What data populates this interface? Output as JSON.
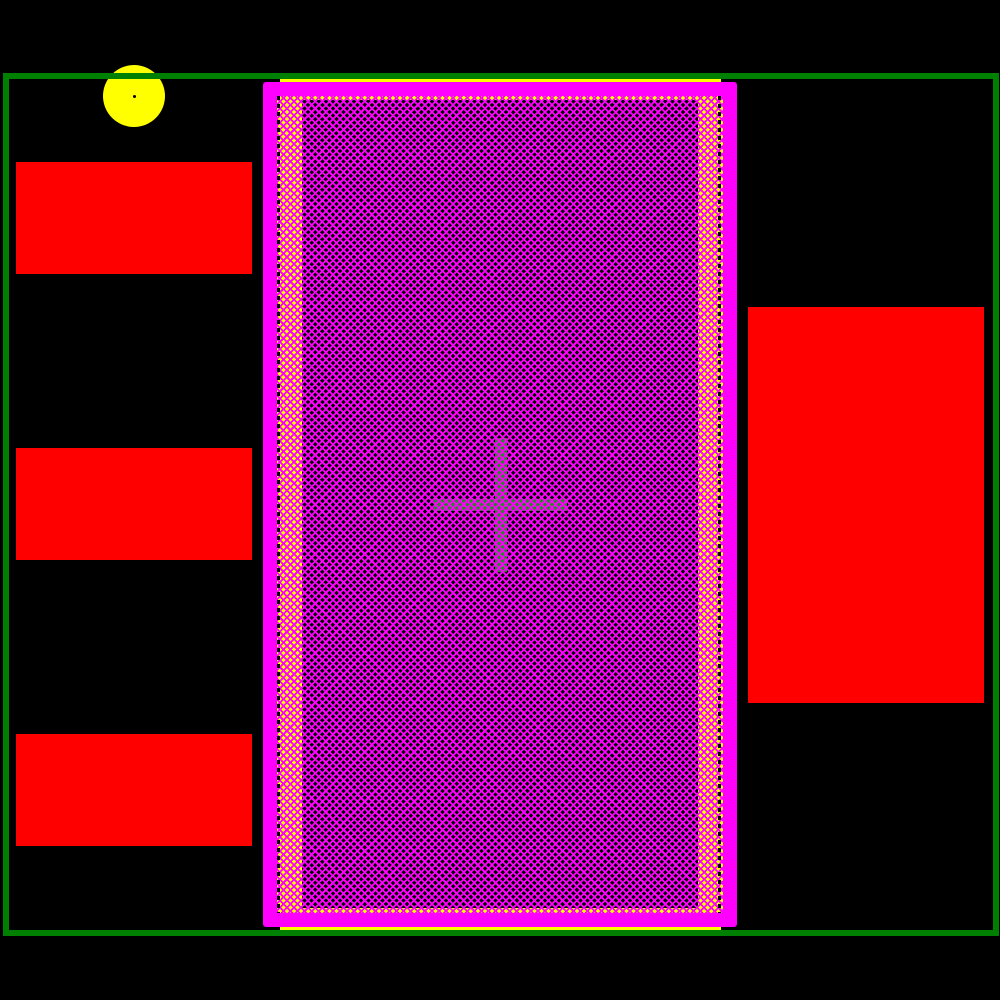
{
  "canvas": {
    "width": 1000,
    "height": 1000,
    "background": "#000000"
  },
  "colors": {
    "courtyard_green": "#008000",
    "copper_pad_red": "#FF0000",
    "solder_mask_magenta": "#FF00FF",
    "paste_yellow": "#FFFF00",
    "hatch_magenta": "#FF00FF",
    "crosshair_green": "#228B22",
    "pin1_circle_yellow": "#FFFF00",
    "background_black": "#000000"
  },
  "courtyard_outline": {
    "left": 3,
    "top": 73,
    "width": 996,
    "height": 863,
    "stroke": 6,
    "color": "#008000"
  },
  "pin1_marker": {
    "circle": {
      "left": 103,
      "top": 65,
      "diameter": 62,
      "color": "#FFFF00"
    },
    "center_dot": {
      "left": 133,
      "top": 95,
      "diameter": 3,
      "color": "#000000"
    }
  },
  "copper_pads": {
    "color": "#FF0000",
    "left_pads": [
      {
        "left": 16,
        "top": 162,
        "width": 236,
        "height": 112
      },
      {
        "left": 16,
        "top": 448,
        "width": 236,
        "height": 112
      },
      {
        "left": 16,
        "top": 734,
        "width": 236,
        "height": 112
      }
    ],
    "right_pad": {
      "left": 748,
      "top": 307,
      "width": 236,
      "height": 396
    }
  },
  "thermal_pad": {
    "paste_outline": {
      "left": 280,
      "top": 79,
      "width": 441,
      "height": 851,
      "stroke": 3,
      "color": "#FFFF00"
    },
    "mask_frame": {
      "left": 263,
      "top": 82,
      "width": 474,
      "height": 845,
      "stroke": 14,
      "color": "#FF00FF",
      "corner_radius": 3
    },
    "hatch_area": {
      "left": 277,
      "top": 96,
      "width": 446,
      "height": 817,
      "base_color": "#FFFF00"
    },
    "copper_fill": {
      "left": 25,
      "top": 4,
      "width": 396,
      "height": 808,
      "base_color": "#000000"
    },
    "hatch_pattern": {
      "color": "#FF00FF",
      "line_width": 1.8,
      "period": 5
    },
    "edge_dashes": {
      "color": "#000000",
      "width": 3,
      "dash": 4,
      "gap": 4,
      "left": {
        "left": 0,
        "top": 0,
        "height": 817
      },
      "right": {
        "left": 441,
        "top": 0,
        "height": 817
      }
    },
    "crosshair": {
      "color": "#228B22",
      "vertical": {
        "left": 193,
        "top": 338,
        "width": 12,
        "height": 134
      },
      "horizontal": {
        "left": 132,
        "top": 399,
        "width": 133,
        "height": 12
      }
    }
  }
}
